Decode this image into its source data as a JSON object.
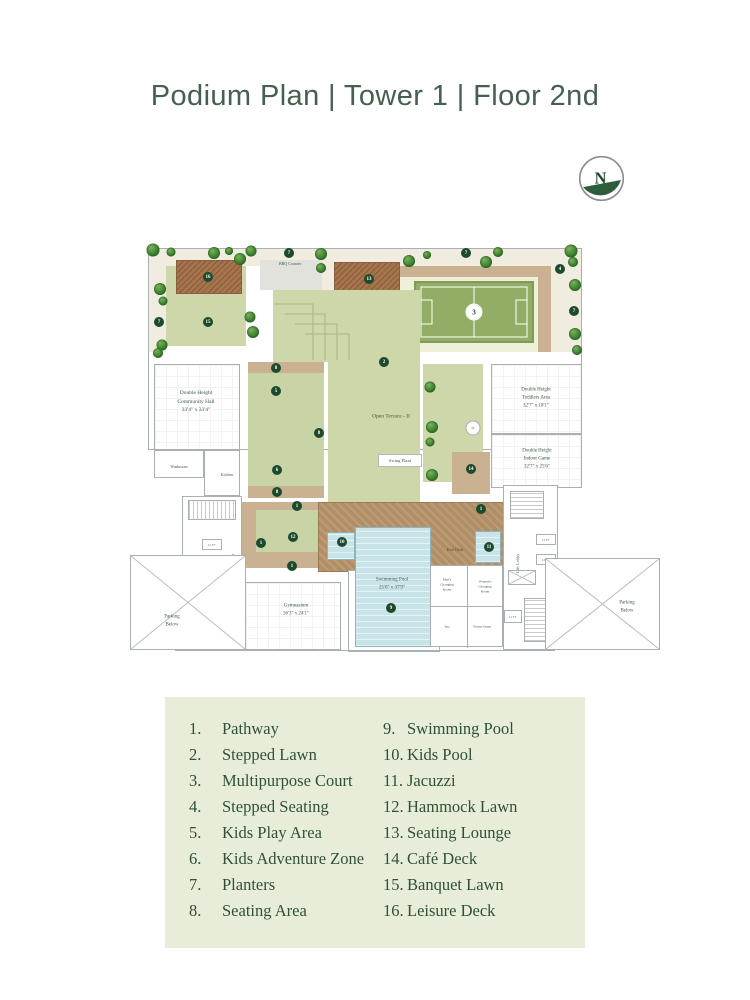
{
  "title": "Podium Plan | Tower 1 | Floor 2nd",
  "compass": {
    "letter": "N"
  },
  "colors": {
    "title_text": "#45604e",
    "legend_bg": "#e8edda",
    "legend_text": "#2e5138",
    "marker_green": "#1d4a2c",
    "lawn_green": "#cdd7a9",
    "court_green": "#93ad66",
    "deck_brown": "#a5744d",
    "pool_deck_brown": "#b28e66",
    "pool_blue": "#c9e4e8",
    "seating_tan": "#cab192",
    "pathway_cream": "#f0ecdf"
  },
  "plan": {
    "labels": {
      "bbq": "BBQ Counter",
      "open_terrace": "Open Terrace - II",
      "swing": "Swing Plaza",
      "community_hall": "Double Height\nCommunity Hall\n33'4\" x 33'4\"",
      "toddlers": "Double Height\nToddlers Area\n32'7\" x 18'1\"",
      "indoor_game": "Double Height\nIndoor Game\n32'7\" x 25'6\"",
      "gymnasium": "Gymnasium\n36'3\" x 24'1\"",
      "swimming_pool": "Swimming Pool\n25'0\" x 37'9\"",
      "pool_deck": "Pool Deck",
      "washroom": "Washroom",
      "kitchen": "Kitchen",
      "mens_changing": "Men's\nChanging\nRoom",
      "womens_changing": "Women's\nChanging\nRoom",
      "spa": "Spa",
      "steam_sauna": "Steam Sauna",
      "lift": "LIFT",
      "lift_lobby": "Lift Lobby",
      "parking_below": "Parking\nBelow"
    },
    "markers": {
      "m1": "1",
      "m2": "2",
      "m3": "3",
      "m4": "4",
      "m5": "5",
      "m6": "6",
      "m7": "7",
      "m8": "8",
      "m9": "9",
      "m10": "10",
      "m11": "11",
      "m12": "12",
      "m13": "13",
      "m14": "14",
      "m15": "15",
      "m16": "16"
    }
  },
  "legend": {
    "items": [
      {
        "num": "1.",
        "label": "Pathway"
      },
      {
        "num": "2.",
        "label": "Stepped Lawn"
      },
      {
        "num": "3.",
        "label": "Multipurpose Court"
      },
      {
        "num": "4.",
        "label": "Stepped Seating"
      },
      {
        "num": "5.",
        "label": "Kids Play Area"
      },
      {
        "num": "6.",
        "label": "Kids Adventure Zone"
      },
      {
        "num": "7.",
        "label": "Planters"
      },
      {
        "num": "8.",
        "label": "Seating Area"
      },
      {
        "num": "9.",
        "label": "Swimming Pool"
      },
      {
        "num": "10.",
        "label": "Kids Pool"
      },
      {
        "num": "11.",
        "label": "Jacuzzi"
      },
      {
        "num": "12.",
        "label": "Hammock Lawn"
      },
      {
        "num": "13.",
        "label": "Seating Lounge"
      },
      {
        "num": "14.",
        "label": "Café Deck"
      },
      {
        "num": "15.",
        "label": "Banquet Lawn"
      },
      {
        "num": "16.",
        "label": "Leisure Deck"
      }
    ]
  }
}
